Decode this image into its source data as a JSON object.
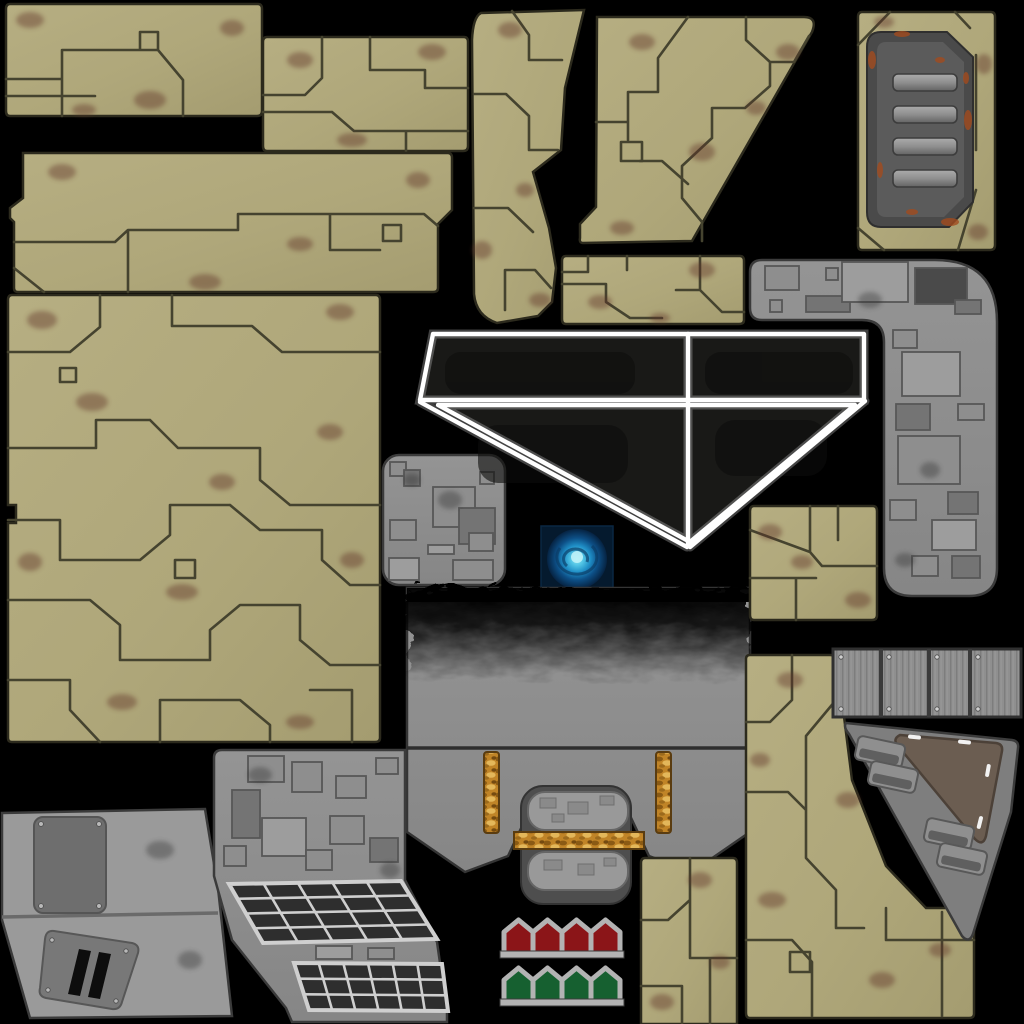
{
  "canvas": {
    "width": 1024,
    "height": 1024,
    "background": "#000000"
  },
  "meta": {
    "kind": "texture-atlas-sprite-sheet",
    "theme": "sci-fi dropship hull texture atlas on black background",
    "sprite_count": 21
  },
  "palette": {
    "background": "#000000",
    "tan_base": "#b2aa7d",
    "tan_shade": "#a39b6f",
    "tan_line": "#45432f",
    "tan_edge": "#2c2a1d",
    "rust_smudge": "#5e3126",
    "gray_base": "#8e8e8e",
    "gray_light": "#9d9d9d",
    "gray_dark": "#747474",
    "gray_line": "#4e4e4e",
    "door_rim": "#4a4a4a",
    "door_face": "#5b5b5b",
    "slat_light": "#a8a8a8",
    "rust_orange": "#a24b1e",
    "canopy_fill": "#191917",
    "canopy_line": "#ffffff",
    "orb_bg": "#051a2e",
    "orb_mid": "#1470ad",
    "orb_core": "#7fe3f2",
    "gold": "#c08427",
    "gold_dark": "#7a4e12",
    "gold_light": "#eac163",
    "grid_cell": "#2e2e2e",
    "grid_line": "#cfcfcf",
    "arrow_red": "#8b1518",
    "arrow_green": "#166030",
    "arrow_frame": "#b3b3b3",
    "soot": "#000000",
    "brown_plate": "#6b5d51"
  },
  "door": {
    "slat_count": 4,
    "slat_x": 893,
    "slat_w": 64,
    "slat_h": 17,
    "slat_ys": [
      74,
      106,
      138,
      170
    ]
  },
  "arrows": {
    "count_per_row": 4,
    "x": 504,
    "w": 29,
    "peak_h": 12,
    "body_h": 33,
    "red_y": 920,
    "green_y": 968,
    "red": "#8b1518",
    "green": "#166030",
    "frame": "#b3b3b3"
  },
  "solar_grids": [
    {
      "rows": 4,
      "cols": 5,
      "quad": [
        [
          229,
          884
        ],
        [
          401,
          881
        ],
        [
          437,
          939
        ],
        [
          263,
          943
        ]
      ]
    },
    {
      "rows": 3,
      "cols": 6,
      "quad": [
        [
          294,
          963
        ],
        [
          442,
          964
        ],
        [
          448,
          1011
        ],
        [
          309,
          1010
        ]
      ]
    }
  ],
  "ribbed_strip": {
    "x_bounds": [
      833,
      881,
      929,
      970,
      1021
    ],
    "y": 649,
    "h": 68
  },
  "counts": {
    "rope_pillars": 2,
    "door_slats": 4,
    "red_arrows": 4,
    "green_arrows": 4,
    "ribbed_segments": 4,
    "canopy_panes": 4,
    "cargo_pods": 2
  },
  "sprites": [
    {
      "name": "tan-hull-panel-a",
      "bbox": [
        6,
        4,
        256,
        112
      ]
    },
    {
      "name": "tan-hull-panel-b",
      "bbox": [
        263,
        37,
        205,
        114
      ]
    },
    {
      "name": "tan-hull-strip-c",
      "bbox": [
        10,
        153,
        442,
        139
      ]
    },
    {
      "name": "tan-hull-large-d",
      "bbox": [
        8,
        295,
        372,
        447
      ]
    },
    {
      "name": "tan-blade-e",
      "bbox": [
        472,
        10,
        113,
        313
      ]
    },
    {
      "name": "tan-trapezoid-f",
      "bbox": [
        578,
        16,
        240,
        227
      ]
    },
    {
      "name": "tan-bar-g",
      "bbox": [
        562,
        256,
        182,
        68
      ]
    },
    {
      "name": "rusty-door-panel-h",
      "bbox": [
        858,
        12,
        137,
        238
      ]
    },
    {
      "name": "gray-elbow-i",
      "bbox": [
        748,
        258,
        249,
        339
      ]
    },
    {
      "name": "gray-greeble-square-j",
      "bbox": [
        383,
        455,
        122,
        130
      ]
    },
    {
      "name": "canopy-window-k",
      "bbox": [
        418,
        332,
        448,
        215
      ]
    },
    {
      "name": "energy-orb-l",
      "bbox": [
        541,
        526,
        72,
        66
      ]
    },
    {
      "name": "engine-block-m",
      "bbox": [
        407,
        588,
        343,
        284
      ]
    },
    {
      "name": "gray-wing-n",
      "bbox": [
        0,
        809,
        232,
        209
      ]
    },
    {
      "name": "solar-panel-o",
      "bbox": [
        213,
        750,
        235,
        274
      ]
    },
    {
      "name": "arrow-markers-p",
      "bbox": [
        501,
        919,
        128,
        87
      ]
    },
    {
      "name": "tan-bar-r",
      "bbox": [
        641,
        858,
        97,
        166
      ]
    },
    {
      "name": "tan-column-s",
      "bbox": [
        746,
        655,
        228,
        363
      ]
    },
    {
      "name": "gray-slab-t",
      "bbox": [
        840,
        720,
        180,
        222
      ]
    },
    {
      "name": "ribbed-strip-u",
      "bbox": [
        833,
        648,
        188,
        70
      ]
    },
    {
      "name": "tan-square-v",
      "bbox": [
        750,
        506,
        127,
        114
      ]
    }
  ]
}
